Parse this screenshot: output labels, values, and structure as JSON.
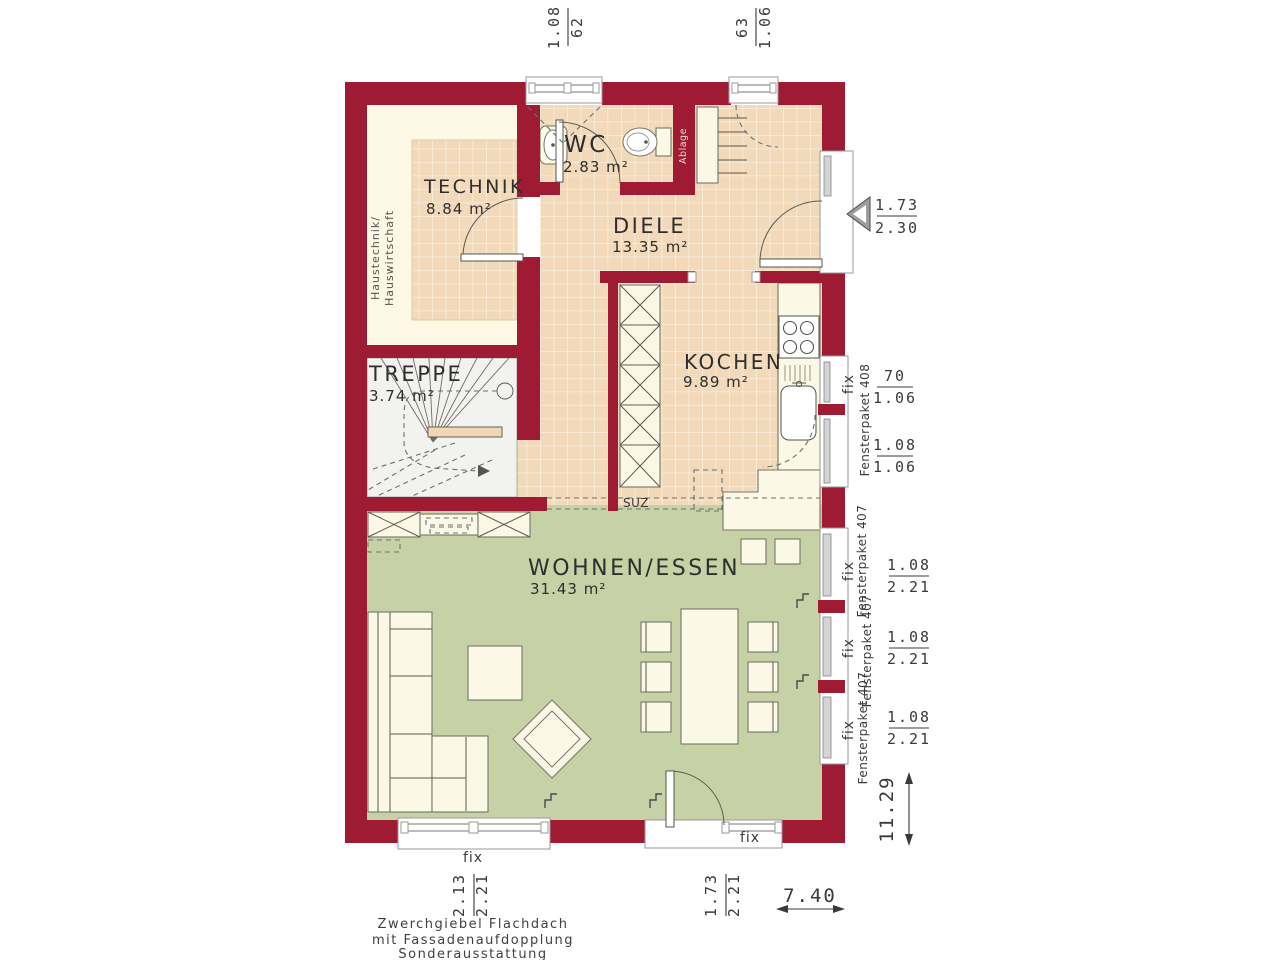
{
  "plan": {
    "rooms": [
      {
        "name": "TECHNIK",
        "area": "8.84 m²"
      },
      {
        "name": "WC",
        "area": "2.83 m²"
      },
      {
        "name": "DIELE",
        "area": "13.35 m²"
      },
      {
        "name": "KOCHEN",
        "area": "9.89 m²"
      },
      {
        "name": "TREPPE",
        "area": "3.74 m²"
      },
      {
        "name": "WOHNEN/ESSEN",
        "area": "31.43 m²"
      }
    ],
    "side_room_label": {
      "line1": "Haustechnik/",
      "line2": "Hauswirtschaft"
    },
    "shelf_label": "Ablage",
    "passage_label": "SUZ"
  },
  "window_labels": {
    "fix": "fix",
    "paket_408": "Fensterpaket 408",
    "paket_407": "Fensterpaket 407"
  },
  "dimensions": {
    "top_window_1": {
      "a": "1.08",
      "b": "62"
    },
    "top_window_2": {
      "a": "63",
      "b": "1.06"
    },
    "entrance_door": {
      "a": "1.73",
      "b": "2.30"
    },
    "kitchen_window_1": {
      "a": "70",
      "b": "1.06"
    },
    "kitchen_window_2": {
      "a": "1.08",
      "b": "1.06"
    },
    "living_window_1": {
      "a": "1.08",
      "b": "2.21"
    },
    "living_window_2": {
      "a": "1.08",
      "b": "2.21"
    },
    "living_window_3": {
      "a": "1.08",
      "b": "2.21"
    },
    "bottom_window": {
      "a": "2.13",
      "b": "2.21"
    },
    "bottom_door": {
      "a": "1.73",
      "b": "2.21"
    },
    "overall_height": "11.29",
    "overall_width": "7.40"
  },
  "footer": {
    "line1": "Zwerchgiebel Flachdach",
    "line2": "mit Fassadenaufdopplung",
    "line3": "Sonderausstattung"
  },
  "colors": {
    "wall": "#9e1b33",
    "tile_floor": "#f2d9ba",
    "tile_grout": "#faeeda",
    "living_floor": "#c6d2a5",
    "technik_floor": "#fdf9e6",
    "stair_floor": "#f2f2ee"
  }
}
